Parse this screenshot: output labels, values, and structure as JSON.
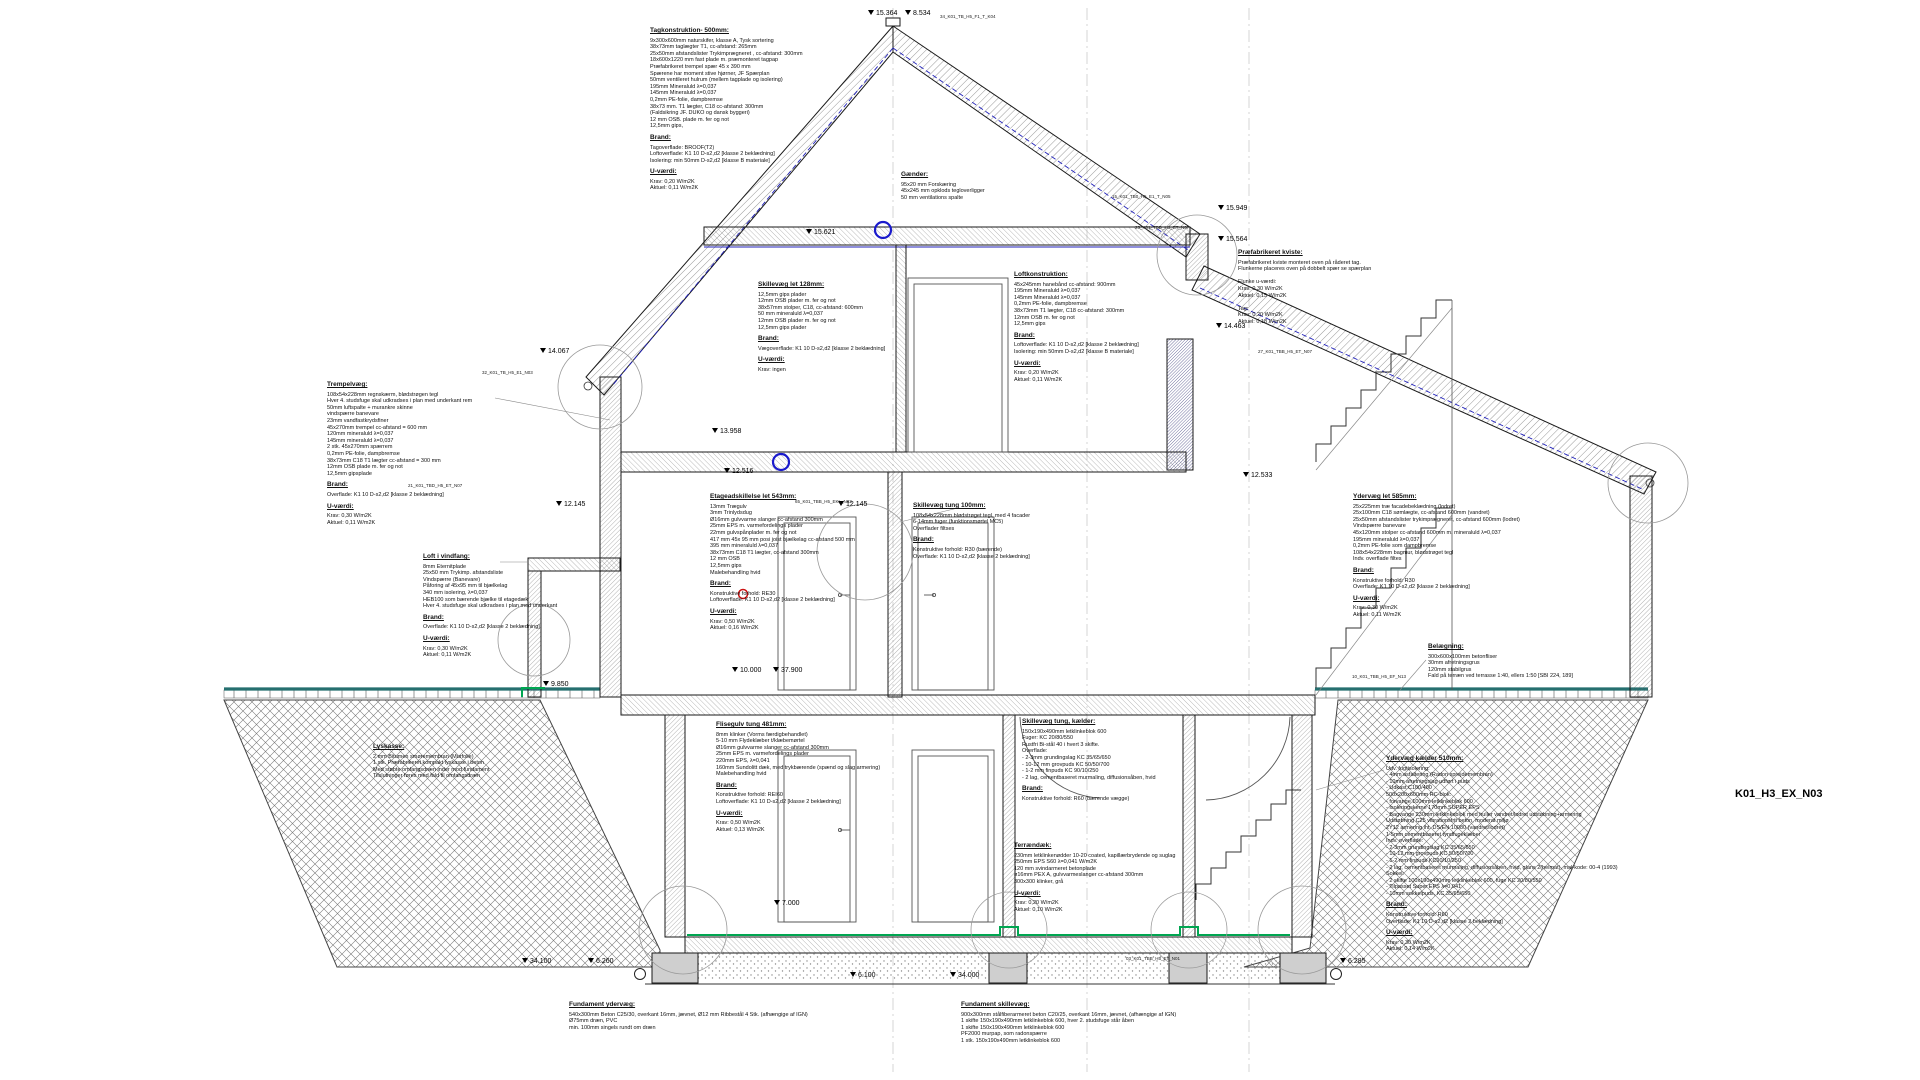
{
  "drawing_number": "K01_H3_EX_N03",
  "levels": {
    "ridge": "15.364",
    "ridge2": "8.534",
    "loft": "15.621",
    "kvist_top": "15.949",
    "kvist_low": "15.564",
    "left_eave": "14.067",
    "right_mid": "14.463",
    "floor2_top": "13.958",
    "floor2": "12.516",
    "floor2_left": "12.145",
    "floor2_center": "12.145",
    "right_roof": "12.533",
    "ground": "10.000",
    "ground2": "37.900",
    "terrain_left": "9.850",
    "basement": "7.000",
    "found_left_a": "34.100",
    "found_left_b": "6.260",
    "found_mid_a": "6.100",
    "found_mid_b": "34.000",
    "found_right": "6.285"
  },
  "refs": {
    "r1": "34_K01_TB_H5_F1_T_K04",
    "r2": "15_K01_TB0_H5_E1_T_N05",
    "r3": "25_K01_TBD_H5_ET_N07",
    "r4": "32_K01_TB_H5_E1_N03",
    "r5": "27_K01_TBB_H5_ET_N07",
    "r6": "65_K01_TBB_H5_EKL_N03",
    "r7": "10_K01_TBB_H5_EF_N13",
    "r8": "03_K01_TBB_H5_ET_N01",
    "r9": "21_K01_TBD_H5_ET_N07"
  },
  "notes": {
    "tag": {
      "title": "Tagkonstruktion- 500mm:",
      "lines": [
        "9x300x600mm naturskifer, klasse A, Tysk sortering",
        "38x73mm taglægter T1, cc-afstand: 265mm",
        "25x50mm afstandslister Trykimprægneret , cc-afstand: 300mm",
        "18x600x1220 mm fast plade m. præmonteret tagpap",
        "Præfabrikeret trempel spær 45 x 390 mm",
        "Spærene har moment stive hjørner, JF Spærplan",
        "50mm ventileret hulrum (mellem tagplade og isolering)",
        "195mm Mineraluld λ=0,037",
        "145mm Mineraluld λ=0,037",
        "0,2mm PE-folie, dampbremse",
        "38x73 mm. T1 lægter, C18 cc-afstand: 300mm",
        "(Faldsikring JF. DUKO og dansk byggeri)",
        "12 mm OSB. plade m. fer og not",
        "12,5mm gips,"
      ],
      "brand_title": "Brand:",
      "brand": [
        "Tagoverflade: BROOF(T2)",
        "Loftoverflade: K1 10 D-s2,d2 [klasse 2 beklædning]",
        "Isolering: min 50mm D-s2,d2 [klasse B materiale]"
      ],
      "u_title": "U-værdi:",
      "u": [
        "Krav: 0,20 W/m2K",
        "Aktuel: 0,11 W/m2K"
      ]
    },
    "gaender": {
      "title": "Gænder:",
      "lines": [
        "95x20 mm Forskæring",
        "45x245 mm opklods tegloverligger",
        "50 mm ventilations spalte"
      ]
    },
    "kviste": {
      "title": "Præfabrikeret kviste:",
      "lines": [
        "Præfabrikeret kviste monteret oven på råderet tag.",
        "Flunkerne placeres oven på dobbelt spær se spærplan",
        "",
        "Flunke u-værdi:",
        "Krav: 0,30 W/m2K",
        "Aktuel: 0,15 W/m2K",
        "",
        "Tag:",
        "Krav: 0,20 W/m2K",
        "Aktuel: 0,18 W/m2K"
      ]
    },
    "loftkon": {
      "title": "Loftkonstruktion:",
      "lines": [
        "45x245mm hanebånd cc-afstand: 900mm",
        "195mm Mineraluld λ=0,037",
        "145mm Mineraluld λ=0,037",
        "0,2mm PE-folie, dampbremse",
        "38x73mm T1 lægter, C18 cc-afstand: 300mm",
        "12mm OSB m. fer og not",
        "12,5mm gips"
      ],
      "brand_title": "Brand:",
      "brand": [
        "Loftoverflade: K1 10 D-s2,d2 [klasse 2 beklædning]",
        "Isolering: min 50mm D-s2,d2 [klasse B materiale]"
      ],
      "u_title": "U-værdi:",
      "u": [
        "Krav: 0,20 W/m2K",
        "Aktuel: 0,11 W/m2K"
      ]
    },
    "sk128": {
      "title": "Skillevæg let 128mm:",
      "lines": [
        "12,5mm gips plader",
        "12mm OSB plader m. fer og not",
        "38x57mm stolper, C18, cc-afstand: 600mm",
        "50 mm mineraluld λ=0,037",
        "12mm OSB plader m. fer og not",
        "12,5mm gips plader"
      ],
      "brand_title": "Brand:",
      "brand": [
        "Vægoverflade: K1 10 D-s2,d2 [klasse 2 beklædning]"
      ],
      "u_title": "U-værdi:",
      "u": [
        "Krav: ingen"
      ]
    },
    "trempel": {
      "title": "Trempelvæg:",
      "lines": [
        "108x54x228mm regnskærm, blødstrøgen tegl",
        "Hver 4. studsfuge skal udkradses i plan med underkant rem",
        "50mm luftspalte + murankre skinne",
        "vindspærre banevare",
        "23mm vandfastkrydsfiner",
        "45x270mm trempel cc-afstand = 600 mm",
        "120mm mineraluld λ=0,037",
        "145mm mineraluld λ=0,037",
        "2 stk. 45x270mm spærrem",
        "0,2mm PE-folie, dampbremse",
        "38x73mm C18 T1 lægter cc-afstand = 300 mm",
        "12mm OSB plade m. fer og not",
        "12,5mm gipsplade"
      ],
      "brand_title": "Brand:",
      "brand": [
        "Overflade: K1 10 D-s2,d2 [klasse 2 beklædning]"
      ],
      "u_title": "U-værdi:",
      "u": [
        "Krav: 0,30 W/m2K",
        "Aktuel: 0,11 W/m2K"
      ]
    },
    "loftvind": {
      "title": "Loft i vindfang:",
      "lines": [
        "8mm Eternitplade",
        "25x50 mm Trykimp. afstandsliste",
        "Vindspærre (Banevare)",
        "Påforing af 45x95 mm til bjælkelag",
        "340 mm isolering, λ=0,037",
        "HEB100 som bærende bjælke til etagedæk",
        "Hver 4. studsfuge skal udkradses i plan med underkant"
      ],
      "brand_title": "Brand:",
      "brand": [
        "Overflade: K1 10 D-s2,d2 [klasse 2 beklædning]"
      ],
      "u_title": "U-værdi:",
      "u": [
        "Krav: 0,30 W/m2K",
        "Aktuel: 0,11 W/m2K"
      ]
    },
    "etage543": {
      "title": "Etageadskillelse let 543mm:",
      "lines": [
        "13mm Trægulv",
        "3mm Trinlydsdug",
        "Ø16mm gulvvarme slanger cc-afstand 300mm",
        "25mm EPS m. varmefordelings plader",
        "22mm gulvspånplader m. fer og not",
        "417 mm 45x 95 mm posi joist bjælkelag cc-afstand 500 mm",
        "395 mm mineraluld λ=0,037",
        "38x73mm C18 T1 lægter, cc-afstand 300mm",
        "12 mm OSB",
        "12,5mm gips",
        "Malebehandling hvid"
      ],
      "brand_title": "Brand:",
      "brand": [
        "Konstruktive forhold: RE30",
        "Loftoverflade: K1 10 D-s2,d2 [klasse 2 beklædning]"
      ],
      "u_title": "U-værdi:",
      "u": [
        "Krav: 0,50 W/m2K",
        "Aktuel: 0,16 W/m2K"
      ]
    },
    "sk100": {
      "title": "Skillevæg tung 100mm:",
      "lines": [
        "108x54x228mm blødstrøget tegl, med 4 facader",
        "6-14mm fuger (funktionsmørtel MC5)",
        "Overflader filtses"
      ],
      "brand_title": "Brand:",
      "brand": [
        "Konstruktive forhold: R30 (bærende)",
        "Overflade: K1 10 D-s2,d2 [klasse 2 beklædning]"
      ]
    },
    "ydl585": {
      "title": "Ydervæg let 585mm:",
      "lines": [
        "25x225mm træ facadebeklædning (lodret)",
        "25x100mm C18 sømlægte, cc-afstand 600mm (vandret)",
        "25x50mm afstandslister trykimprægneret, cc-afstand 600mm (lodret)",
        "Vindspærre banevare",
        "45x120mm stolper cc-afstand 600mm m. mineraluld λ=0,037",
        "195mm mineraluld λ=0,037",
        "0,2mm PE-folie som dampbremse",
        "108x54x228mm bagmur, blødstrøget tegl",
        "Indv. overflade filtes"
      ],
      "brand_title": "Brand:",
      "brand": [
        "Konstruktive forhold: R30",
        "Overflade: K1 10 D-s2,d2 [klasse 2 beklædning]"
      ],
      "u_title": "U-værdi:",
      "u": [
        "Krav: 0,30 W/m2K",
        "Aktuel: 0,11 W/m2K"
      ]
    },
    "belaeg": {
      "title": "Belægning:",
      "lines": [
        "300x600x100mm betonfliser",
        "30mm afretningsgrus",
        "120mm stabilgrus",
        "Fald på terræn ved terrasse 1:40, ellers 1:50 [SBI 224, 189]"
      ]
    },
    "lyskasse": {
      "title": "Lyskasse:",
      "lines": [
        "2 mm Bitumen smøremembran (Murfolie)",
        "1 stk. Præfabrikeret kompakt lyskasse i beton",
        "Med støbte omfangsdræn inder mod fundament",
        "Tilslutninger føres med fald til omfangsdræn"
      ]
    },
    "flisegulv": {
      "title": "Flisegulv tung 481mm:",
      "lines": [
        "8mm klinker (Vorms færdigbehandlet)",
        "5-10 mm Flydeklæber t/klæbemørtel",
        "Ø16mm gulvvarme slanger cc-afstand 300mm",
        "25mm EPS m. varmefordelings plader",
        "220mm EPS, λ=0,041",
        "160mm Sundolitt dæk, med trykbærende (spænd og slag armering)",
        "Malebehandling hvid"
      ],
      "brand_title": "Brand:",
      "brand": [
        "Konstruktive forhold: REI60",
        "Loftoverflade: K1 10 D-s2,d2 [klasse 2 beklædning]"
      ],
      "u_title": "U-værdi:",
      "u": [
        "Krav: 0,50 W/m2K",
        "Aktuel: 0,13 W/m2K"
      ]
    },
    "sktk": {
      "title": "Skillevæg tung, kælder:",
      "lines": [
        "150x190x490mm letklinkeblok 600",
        "Fuger: KC 20/80/550",
        "Rustfri Bi-stål 40 i hvert 3 skifte.",
        "Overflade:",
        "- 2-3mm grundingslag KC 35/65/650",
        "- 10-12 mm grovpuds KC 50/50/700",
        "- 1-2 mm finpuds KC 90/10/250",
        "- 2 lag, cementbaseret murmaling, diffusionsåben, hvid"
      ],
      "brand_title": "Brand:",
      "brand": [
        "Konstruktive forhold: R60 (bærende vægge)"
      ]
    },
    "terraen": {
      "title": "Terrændæk:",
      "lines": [
        "230mm letklinkenødder 10-20 coated, kapillærbrydende og suglag",
        "250mm EPS S60 λ=0,041 W/m2K",
        "120 mm svindarmeret betonplade",
        "ø16mm PEX A, gulvvarmeslanger cc-afstand 300mm",
        "300x300 klinker, grå"
      ],
      "u_title": "U-værdi:",
      "u": [
        "Krav: 0,20 W/m2K",
        "Aktuel: 0,10 W/m2K"
      ]
    },
    "ydk510": {
      "title": "Ydervæg kælder 510mm:",
      "lines": [
        "Udv. fugtisolering:",
        "- 4mm asfaltering (Radon sprejdemembran)",
        "- 10mm afretningslag udført i puds",
        "- Udkast C100/400",
        "500x200x600mm RC-blok:",
        "- forvange 100mm letklinkeblok 600",
        "- Isoleringskerne 170mm SUPER EPS",
        "- Bagvange 230mm letklinkeblok med huller vandret/lodret udstøbning+armering",
        "Udstøbning C25 vibrationsfrit beton, moderat miljø",
        "2Y12 armering iht. DS/EN 10080 (vandret/lodret)",
        "1-5mm cementbaseret tyndfugeklæber",
        "Indv. overflade:",
        "- 2-3mm grundingslag KC 35/65/650",
        "- 10-12 mm grovpuds KC 50/50/700",
        "- 1-2 mm finpuds KC90/10/250",
        "- 2 lag, cementbaseret murmaling, diffusionsåben, hvid, glans 2(helmat), mal-kode: 00-4 (1993)",
        "Sokkel:",
        "- 2 skifte 100x190x490mm letklinkeblok 600, fuge KC 20/80/550",
        "- Tilpasset Super EPS λ=0,041",
        "- 10mm sokkelpuds, KC 35/65/650"
      ],
      "brand_title": "Brand:",
      "brand": [
        "Konstruktive forhold: R60",
        "Overflade: K1 10 D-s2,d2 [klasse 2 beklædning]"
      ],
      "u_title": "U-værdi:",
      "u": [
        "Krav: 0,30 W/m2K",
        "Aktuel: 0,14 W/m2K"
      ]
    },
    "fundyd": {
      "title": "Fundament ydervæg:",
      "lines": [
        "540x300mm Beton C25/30, overkant 16mm, jævnet, Ø12 mm Ribbestål 4 Stk. (afhængige af IGN)",
        "Ø75mm dræn, PVC",
        "min. 100mm singels rundt om dræn"
      ]
    },
    "fundsk": {
      "title": "Fundament skillevæg:",
      "lines": [
        "900x300mm stålfiberarmeret beton C20/25, overkant 16mm, jævnet, (afhængige af IGN)",
        "1 skifte 150x190x490mm letklinkeblok 600, hver 2. studsfuge står åben",
        "1 skifte 150x190x490mm letklinkeblok 600",
        "PF2000 murpap, som radonspærre",
        "1 stk. 150x190x490mm letklinkeblok 600"
      ]
    }
  },
  "colors": {
    "terrain": "#256f6f",
    "radon_green": "#00a651",
    "level_blue": "#2222bb",
    "mark_red": "#cc1111"
  }
}
